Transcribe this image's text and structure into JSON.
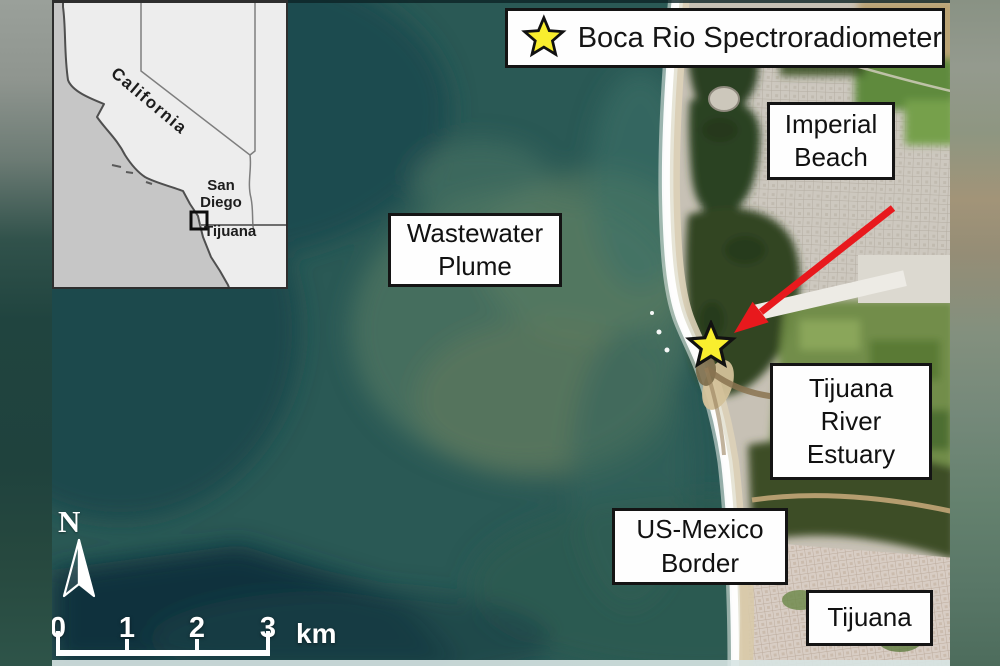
{
  "inset_map": {
    "state_label": "California",
    "san_diego_label": "San Diego",
    "tijuana_label": "Tijuana"
  },
  "legend": {
    "icon": "star-icon",
    "label": "Boca Rio Spectroradiometer"
  },
  "map_labels": {
    "imperial_beach": {
      "lines": [
        "Imperial",
        "Beach"
      ]
    },
    "wastewater_plume": {
      "lines": [
        "Wastewater",
        "Plume"
      ]
    },
    "tijuana_river_estuary": {
      "lines": [
        "Tijuana",
        "River",
        "Estuary"
      ]
    },
    "us_mexico_border": {
      "lines": [
        "US-Mexico",
        "Border"
      ]
    },
    "tijuana": {
      "lines": [
        "Tijuana"
      ]
    }
  },
  "north_arrow": {
    "label": "N"
  },
  "scale_bar": {
    "tick_labels": [
      "0",
      "1",
      "2",
      "3"
    ],
    "unit_label": "km"
  },
  "colors": {
    "arrow_red": "#e8191d",
    "star_yellow": "#f9ee2e",
    "star_outline": "#111111",
    "label_bg": "#fefefe",
    "label_border": "#141414",
    "ocean_deep": "#1d4a4c",
    "ocean_plume": "#567a62"
  }
}
